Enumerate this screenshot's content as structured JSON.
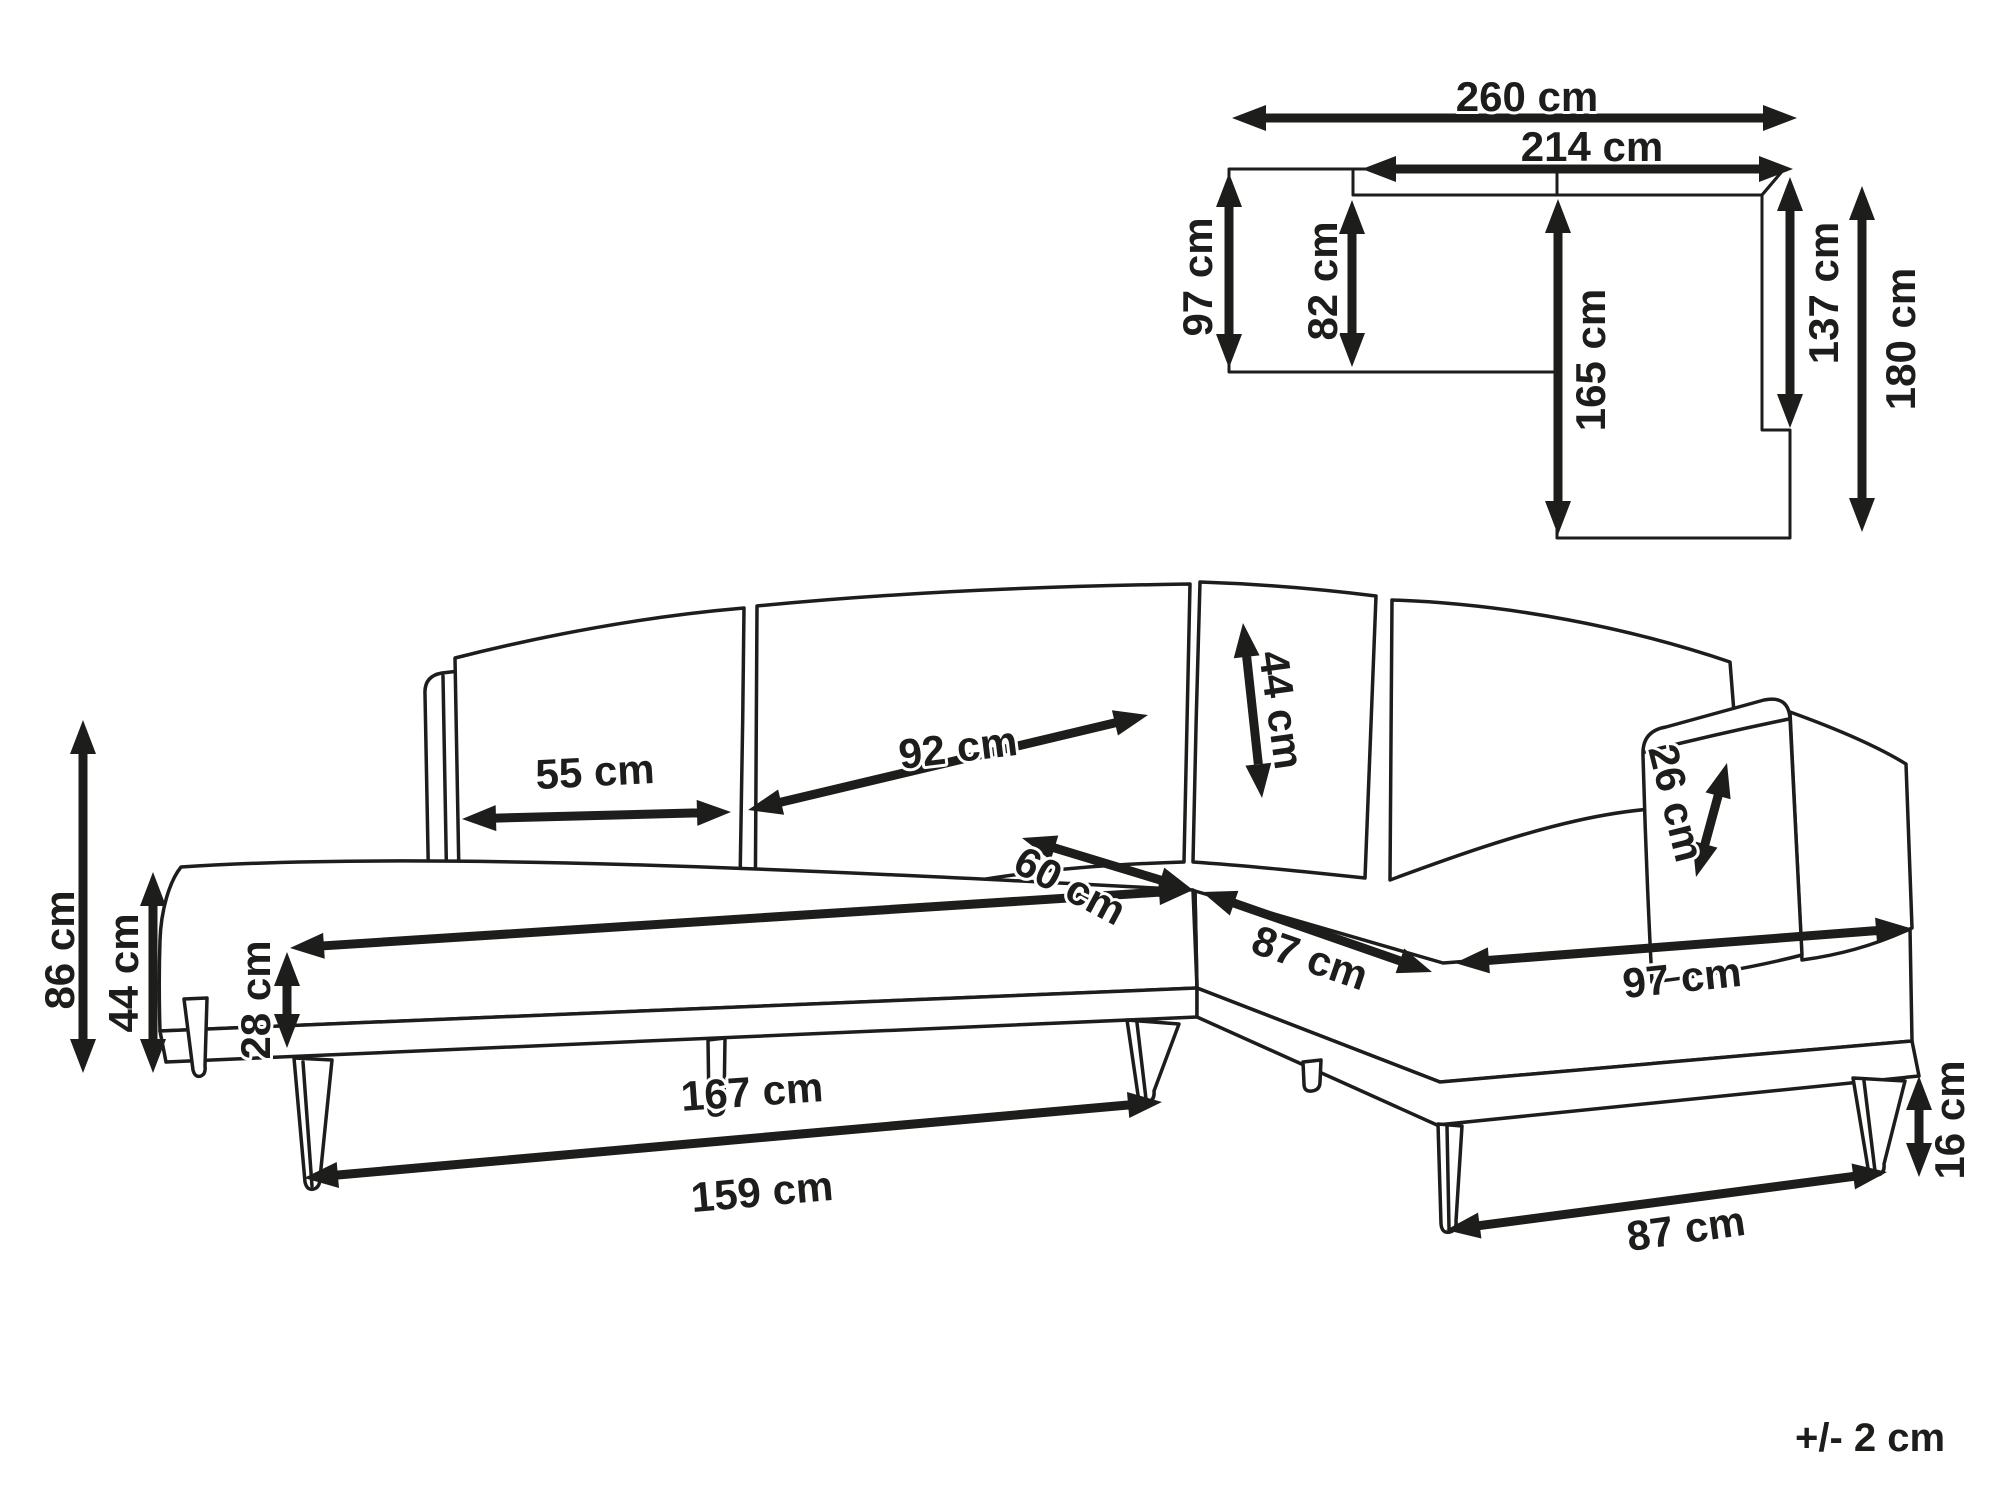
{
  "diagram": {
    "type": "corner-sofa dimension drawing",
    "ink_color": "#1d1d1b",
    "background": "#ffffff"
  },
  "plan": {
    "overall_width": "260 cm",
    "inner_width": "214 cm",
    "left_depth": "97 cm",
    "left_inner_depth": "82 cm",
    "chaise_length": "165 cm",
    "chaise_inner_length": "137 cm",
    "overall_depth": "180 cm"
  },
  "front": {
    "overall_height": "86 cm",
    "seat_height": "44 cm",
    "base_height": "28 cm",
    "back_cushion_small": "55 cm",
    "back_cushion_large": "92 cm",
    "corner_cushion": "44 cm",
    "armrest_above_seat": "26 cm",
    "seat_depth": "60 cm",
    "seat_front_length": "167 cm",
    "base_front_length": "159 cm",
    "corner_seat_width": "87 cm",
    "chaise_front_width": "97 cm",
    "chaise_base_width": "87 cm",
    "leg_height": "16 cm"
  },
  "footnote": {
    "tolerance": "+/- 2 cm"
  }
}
